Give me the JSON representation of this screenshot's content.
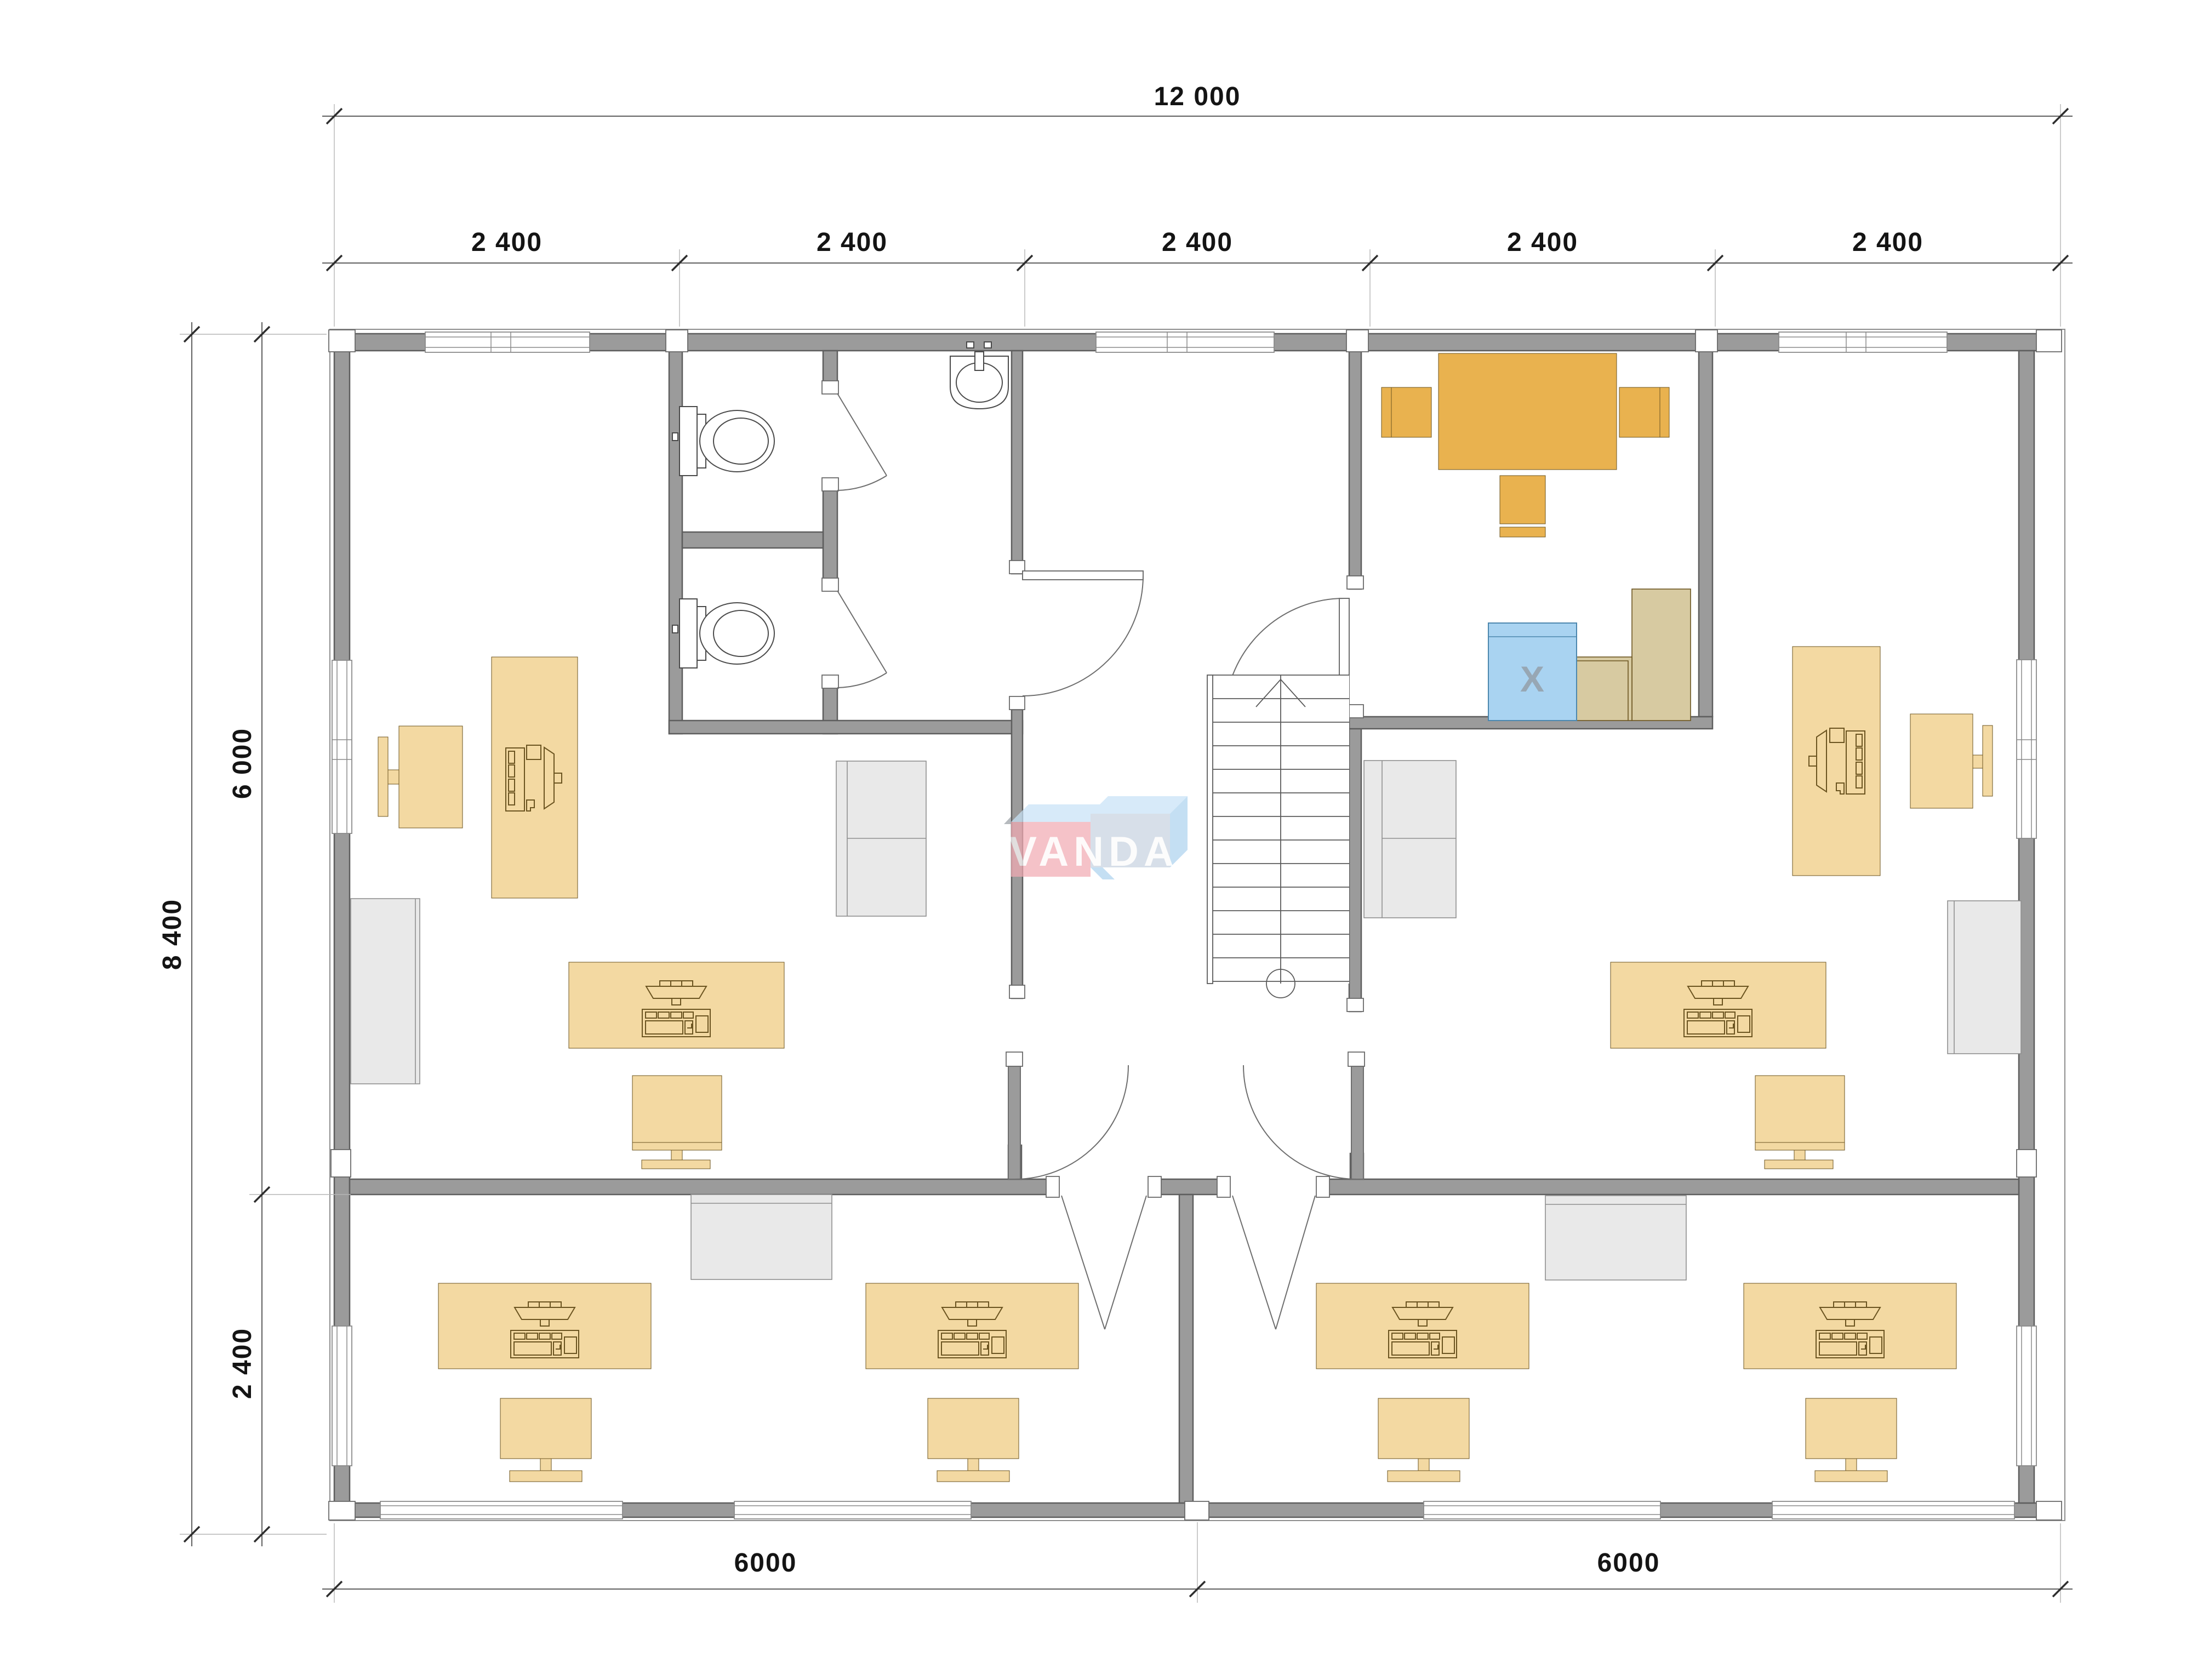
{
  "dimensions": {
    "top_total": "12 000",
    "top_bays": [
      "2 400",
      "2 400",
      "2 400",
      "2 400",
      "2 400"
    ],
    "left_total": "8 400",
    "left_upper": "6 000",
    "left_lower": "2 400",
    "bottom_left": "6000",
    "bottom_right": "6000"
  },
  "watermark": {
    "text": "VANDA"
  },
  "kitchen_room": {
    "appliance_label": "X"
  },
  "colors": {
    "wall": "#9b9b9b",
    "wall_stroke": "#5e5e5e",
    "window_line": "#8a8a8a",
    "desk_fill": "#f3d9a2",
    "desk_stroke": "#6b5420",
    "meeting_fill": "#e9b24f",
    "counter_fill": "#d7caa1",
    "appliance_fill": "#a9d3f1",
    "appliance_stroke": "#4c87ae",
    "appliance_x": "#97a7b4",
    "gray_fill": "#e9e9e9",
    "gray_stroke": "#8f8f8f",
    "fixture_stroke": "#4a4a4a",
    "door_stroke": "#6e6e6e",
    "dim_color": "#141414",
    "logo_pink": "#f2abb3",
    "logo_blue_top": "#c8e3f7",
    "logo_blue_face": "#c9d4e1",
    "logo_blue_side": "#aed3ef"
  },
  "icons": {
    "stairs": "stairs-icon",
    "toilet": "toilet-icon",
    "sink": "sink-icon",
    "computer": "computer-icon",
    "door_swing": "door-arc-icon"
  }
}
